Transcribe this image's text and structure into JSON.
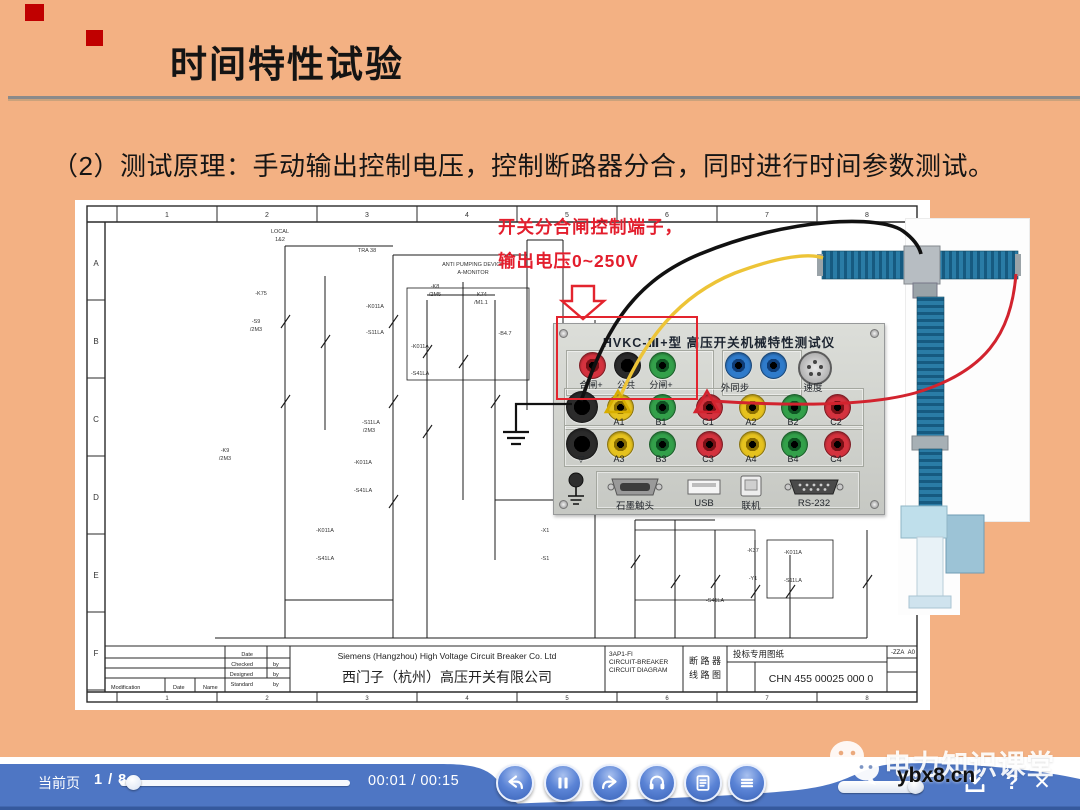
{
  "colors": {
    "slide_bg": "#f3b183",
    "annotation_red": "#e3242e",
    "bar_blue": "#4e76c4",
    "deco_red": "#c00000"
  },
  "slide": {
    "title": "时间特性试验",
    "body": "（2）测试原理：手动输出控制电压，控制断路器分合，同时进行时间参数测试。",
    "annotation": {
      "line1": "开关分合闸控制端子，",
      "line2": "输出电压0~250V"
    }
  },
  "panel": {
    "title": "HVKC-Ⅲ+型  高压开关机械特性测试仪",
    "row1": [
      {
        "color": "red",
        "label": "合闸+"
      },
      {
        "color": "black",
        "label": "公共"
      },
      {
        "color": "green",
        "label": "分闸+"
      }
    ],
    "sync_label": "外同步",
    "speed_label": "速度",
    "row2": [
      {
        "color": "yellow",
        "label": "A1"
      },
      {
        "color": "green",
        "label": "B1"
      },
      {
        "color": "red",
        "label": "C1"
      },
      {
        "color": "yellow",
        "label": "A2"
      },
      {
        "color": "green",
        "label": "B2"
      },
      {
        "color": "red",
        "label": "C2"
      }
    ],
    "row3": [
      {
        "color": "yellow",
        "label": "A3"
      },
      {
        "color": "green",
        "label": "B3"
      },
      {
        "color": "red",
        "label": "C3"
      },
      {
        "color": "yellow",
        "label": "A4"
      },
      {
        "color": "green",
        "label": "B4"
      },
      {
        "color": "red",
        "label": "C4"
      }
    ],
    "row3_first_label": "▽",
    "ports": [
      {
        "type": "vga",
        "label": "石墨触头"
      },
      {
        "type": "usb",
        "label": "USB"
      },
      {
        "type": "square",
        "label": "联机"
      },
      {
        "type": "db9",
        "label": "RS-232"
      }
    ]
  },
  "schematic": {
    "col_numbers": [
      "1",
      "2",
      "3",
      "4",
      "5",
      "6",
      "7",
      "8"
    ],
    "row_letters": [
      "A",
      "B",
      "C",
      "D",
      "E",
      "F"
    ],
    "notes": [
      {
        "x": 205,
        "y": 33,
        "t": "LOCAL"
      },
      {
        "x": 205,
        "y": 41,
        "t": "1&2"
      },
      {
        "x": 186,
        "y": 95,
        "t": "-K75"
      },
      {
        "x": 181,
        "y": 123,
        "t": "-S9"
      },
      {
        "x": 181,
        "y": 131,
        "t": "/2M3"
      },
      {
        "x": 292,
        "y": 52,
        "t": "TRA 38"
      },
      {
        "x": 300,
        "y": 108,
        "t": "-K011A"
      },
      {
        "x": 300,
        "y": 134,
        "t": "-S11LA"
      },
      {
        "x": 296,
        "y": 224,
        "t": "-S11LA"
      },
      {
        "x": 294,
        "y": 232,
        "t": "/2M3"
      },
      {
        "x": 288,
        "y": 264,
        "t": "-K011A"
      },
      {
        "x": 288,
        "y": 292,
        "t": "-S41LA"
      },
      {
        "x": 360,
        "y": 88,
        "t": "-K8"
      },
      {
        "x": 360,
        "y": 96,
        "t": "/2M5"
      },
      {
        "x": 406,
        "y": 96,
        "t": "-K74"
      },
      {
        "x": 406,
        "y": 104,
        "t": "/M1.1"
      },
      {
        "x": 398,
        "y": 66,
        "t": "ANTI PUMPING DEVICE"
      },
      {
        "x": 398,
        "y": 74,
        "t": "A-MONITOR"
      },
      {
        "x": 345,
        "y": 148,
        "t": "-K011A"
      },
      {
        "x": 345,
        "y": 175,
        "t": "-S41LA"
      },
      {
        "x": 430,
        "y": 135,
        "t": "-B4.7"
      },
      {
        "x": 250,
        "y": 332,
        "t": "-K011A"
      },
      {
        "x": 250,
        "y": 360,
        "t": "-S41LA"
      },
      {
        "x": 470,
        "y": 332,
        "t": "-X1"
      },
      {
        "x": 470,
        "y": 360,
        "t": "-S1"
      },
      {
        "x": 640,
        "y": 402,
        "t": "-S41LA"
      },
      {
        "x": 678,
        "y": 352,
        "t": "-K37"
      },
      {
        "x": 678,
        "y": 380,
        "t": "-Y1"
      },
      {
        "x": 718,
        "y": 354,
        "t": "-K011A"
      },
      {
        "x": 718,
        "y": 382,
        "t": "-S11LA"
      },
      {
        "x": 150,
        "y": 252,
        "t": "-K9"
      },
      {
        "x": 150,
        "y": 260,
        "t": "/2M3"
      }
    ],
    "title_block": {
      "company_en": "Siemens (Hangzhou) High Voltage Circuit Breaker Co. Ltd",
      "company_cn": "西门子（杭州）高压开关有限公司",
      "model": "3AP1-FI",
      "type1": "CIRCUIT-BREAKER",
      "type2": "CIRCUIT DIAGRAM",
      "type_cn1": "断 路 器",
      "type_cn2": "线 路 图",
      "doc_note": "投标专用图纸",
      "doc_no": "CHN 455 00025 000 0",
      "rev": "-ZZA",
      "sheet": "A0",
      "small_labels": [
        {
          "x": 178,
          "y": 456,
          "t": "Date",
          "a": "end"
        },
        {
          "x": 178,
          "y": 466,
          "t": "Checked",
          "a": "end"
        },
        {
          "x": 198,
          "y": 466,
          "t": "by"
        },
        {
          "x": 178,
          "y": 476,
          "t": "Designed",
          "a": "end"
        },
        {
          "x": 198,
          "y": 476,
          "t": "by"
        },
        {
          "x": 178,
          "y": 486,
          "t": "Standard",
          "a": "end"
        },
        {
          "x": 198,
          "y": 486,
          "t": "by"
        },
        {
          "x": 36,
          "y": 489,
          "t": "Modification"
        },
        {
          "x": 98,
          "y": 489,
          "t": "Date"
        },
        {
          "x": 128,
          "y": 489,
          "t": "Name"
        }
      ]
    }
  },
  "player": {
    "page_label": "当前页",
    "page_value": "1 / 8",
    "time": "00:01 / 00:15",
    "buttons": [
      "back",
      "pause",
      "forward",
      "headset",
      "notes",
      "menu"
    ],
    "help_glyph": "?",
    "close_glyph": "✕",
    "watermark": {
      "brand": "电力知识课堂",
      "url": "ybx8.cn"
    }
  }
}
